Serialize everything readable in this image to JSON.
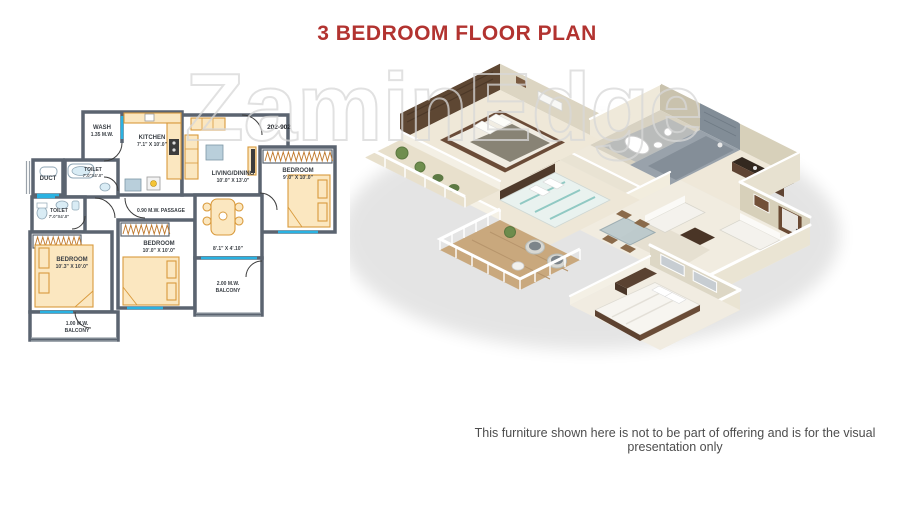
{
  "page": {
    "title": "3 BEDROOM FLOOR PLAN",
    "watermark": "ZaminEdge",
    "disclaimer": "This furniture shown here is not to be part of offering and is for the visual presentation only"
  },
  "colors": {
    "title_red": "#B23330",
    "wall_gray": "#5B6470",
    "window_cyan": "#2AB2E2",
    "furniture_tan": "#FBE7C0",
    "furniture_outline": "#D99A3C",
    "watermark_gray": "#D8D8D8"
  },
  "plan2d": {
    "unit_number": "202-902",
    "labels": {
      "wash_name": "WASH",
      "wash_dim": "1.35 M.W.",
      "kitchen_name": "KITCHEN",
      "kitchen_dim": "7'.1\" X 10'.0\"",
      "duct": "DUCT",
      "toilet1_name": "TOILET",
      "toilet1_dim": "7'.0\"X4'.0\"",
      "toilet2_name": "TOILET",
      "toilet2_dim": "7'.0\"X4'.0\"",
      "living_name": "LIVING/DINING",
      "living_dim": "10'.0\" X 13'.0\"",
      "bedroom_right_name": "BEDROOM",
      "bedroom_right_dim": "9'.0\" X 10'.0\"",
      "passage": "0.90 M.W. PASSAGE",
      "bedroom_left_name": "BEDROOM",
      "bedroom_left_dim": "10'.3\" X 10'.0\"",
      "bedroom_mid_name": "BEDROOM",
      "bedroom_mid_dim": "10'.0\" X 10'.0\"",
      "dining_dim": "8'.1\" X 4'.10\"",
      "balcony_small_line1": "1.00 M.W.",
      "balcony_small_line2": "BALCONY",
      "balcony_large_line1": "2.00 M.W.",
      "balcony_large_line2": "BALCONY"
    }
  }
}
